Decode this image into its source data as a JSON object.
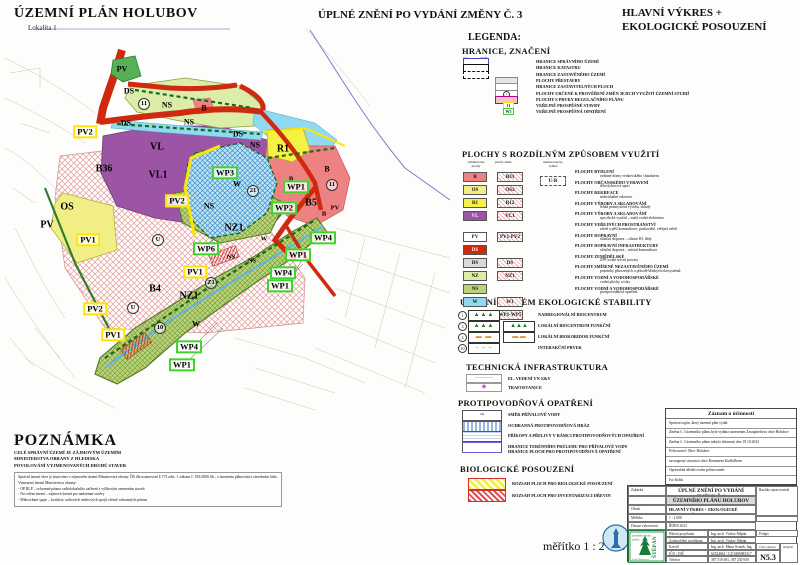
{
  "header": {
    "title_left": "ÚZEMNÍ PLÁN  HOLUBOV",
    "subtitle_left": "Lokalita 1",
    "title_center": "ÚPLNÉ ZNĚNÍ PO VYDÁNÍ ZMĚNY Č. 3",
    "title_right_line1": "HLAVNÍ VÝKRES +",
    "title_right_line2": "EKOLOGICKÉ POSOUZENÍ"
  },
  "colors": {
    "b_pink": "#ee8282",
    "os_yellow": "#f2ee86",
    "r1_yellow": "#f6f145",
    "vl_purple": "#9c55a5",
    "pv_green": "#56b054",
    "ds_red": "#cf2a10",
    "ds_gray": "#d9d9d9",
    "nz_green": "#dcedaa",
    "ns_olive": "#bdd277",
    "w_cyan": "#90d9f0",
    "yellow_box": "#ffe400",
    "green_box": "#3fd42a"
  },
  "map": {
    "labels": [
      {
        "t": "PV",
        "x": 117,
        "y": 41,
        "s": "m"
      },
      {
        "t": "DS",
        "x": 124,
        "y": 63,
        "s": "m"
      },
      {
        "t": "DS",
        "x": 121,
        "y": 95,
        "s": "m"
      },
      {
        "t": "DS",
        "x": 233,
        "y": 106,
        "s": "m"
      },
      {
        "t": "NS",
        "x": 162,
        "y": 77,
        "s": "m"
      },
      {
        "t": "NS",
        "x": 184,
        "y": 94,
        "s": "m"
      },
      {
        "t": "NS",
        "x": 250,
        "y": 117,
        "s": "m"
      },
      {
        "t": "B",
        "x": 199,
        "y": 80,
        "s": "m"
      },
      {
        "t": "B",
        "x": 322,
        "y": 141,
        "s": "m"
      },
      {
        "t": "B",
        "x": 286,
        "y": 151,
        "s": "s"
      },
      {
        "t": "B",
        "x": 319,
        "y": 186,
        "s": "s"
      },
      {
        "t": "B5",
        "x": 306,
        "y": 175,
        "s": "b"
      },
      {
        "t": "PV",
        "x": 330,
        "y": 180,
        "s": "s"
      },
      {
        "t": "R1",
        "x": 278,
        "y": 121,
        "s": "b"
      },
      {
        "t": "VL",
        "x": 152,
        "y": 119,
        "s": "b"
      },
      {
        "t": "VL1",
        "x": 153,
        "y": 147,
        "s": "b"
      },
      {
        "t": "B36",
        "x": 99,
        "y": 141,
        "s": "b"
      },
      {
        "t": "B4",
        "x": 150,
        "y": 261,
        "s": "b"
      },
      {
        "t": "OS",
        "x": 62,
        "y": 179,
        "s": "b"
      },
      {
        "t": "PV",
        "x": 42,
        "y": 197,
        "s": "b"
      },
      {
        "t": "W",
        "x": 232,
        "y": 156,
        "s": "m"
      },
      {
        "t": "W",
        "x": 259,
        "y": 211,
        "s": "s"
      },
      {
        "t": "W",
        "x": 191,
        "y": 296,
        "s": "m"
      },
      {
        "t": "NZ1",
        "x": 184,
        "y": 268,
        "s": "b"
      },
      {
        "t": "NZ1",
        "x": 229,
        "y": 200,
        "s": "b"
      },
      {
        "t": "NS",
        "x": 204,
        "y": 178,
        "s": "m"
      },
      {
        "t": "NS",
        "x": 226,
        "y": 229,
        "s": "s"
      },
      {
        "t": "NS",
        "x": 247,
        "y": 233,
        "s": "s"
      },
      {
        "t": "PV2",
        "x": 80,
        "y": 104,
        "s": "yb"
      },
      {
        "t": "PV2",
        "x": 172,
        "y": 173,
        "s": "yb"
      },
      {
        "t": "PV2",
        "x": 90,
        "y": 281,
        "s": "yb"
      },
      {
        "t": "PV1",
        "x": 83,
        "y": 212,
        "s": "yb"
      },
      {
        "t": "PV1",
        "x": 108,
        "y": 307,
        "s": "yb"
      },
      {
        "t": "PV1",
        "x": 190,
        "y": 244,
        "s": "yb"
      },
      {
        "t": "WP3",
        "x": 220,
        "y": 145,
        "s": "gb"
      },
      {
        "t": "WP1",
        "x": 291,
        "y": 159,
        "s": "gb"
      },
      {
        "t": "WP2",
        "x": 279,
        "y": 180,
        "s": "gb"
      },
      {
        "t": "WP4",
        "x": 318,
        "y": 210,
        "s": "gb"
      },
      {
        "t": "WP6",
        "x": 201,
        "y": 221,
        "s": "gb"
      },
      {
        "t": "WP1",
        "x": 293,
        "y": 227,
        "s": "gb"
      },
      {
        "t": "WP4",
        "x": 278,
        "y": 245,
        "s": "gb"
      },
      {
        "t": "WP1",
        "x": 275,
        "y": 258,
        "s": "gb"
      },
      {
        "t": "WP4",
        "x": 184,
        "y": 319,
        "s": "gb"
      },
      {
        "t": "WP1",
        "x": 177,
        "y": 337,
        "s": "gb"
      },
      {
        "t": "11",
        "x": 139,
        "y": 76,
        "s": "ci"
      },
      {
        "t": "21",
        "x": 248,
        "y": 163,
        "s": "ci"
      },
      {
        "t": "11",
        "x": 327,
        "y": 157,
        "s": "ci"
      },
      {
        "t": "U",
        "x": 153,
        "y": 212,
        "s": "ci"
      },
      {
        "t": "U",
        "x": 128,
        "y": 280,
        "s": "ci"
      },
      {
        "t": "Z1",
        "x": 206,
        "y": 255,
        "s": "ci"
      },
      {
        "t": "10",
        "x": 155,
        "y": 300,
        "s": "ci"
      }
    ]
  },
  "legend": {
    "title": "LEGENDA:",
    "hranice": {
      "title": "HRANICE, ZNAČENÍ",
      "col_stav": "stav",
      "col_navrh": "návrh",
      "items": [
        {
          "sw": "box-blue",
          "label": "HRANICE SPRÁVNÍHO ÚZEMÍ"
        },
        {
          "sw": "box-solid",
          "label": "HRANICE KATASTRU"
        },
        {
          "sw": "box-dash",
          "label": "HRANICE ZASTAVĚNÉHO ÚZEMÍ"
        },
        {
          "sw": "box-gray",
          "label": "PLOCHY PŘESTAVBY"
        },
        {
          "sw": "box-pinkline",
          "label": "HRANICE ZASTAVITELNÝCH PLOCH"
        },
        {
          "sw": "box-circle",
          "code": "1",
          "label": "PLOCHY URČENÉ K PROVĚŘENÍ ZMĚN JEJICH VYUŽITÍ ÚZEMNÍ STUDIÍ"
        },
        {
          "sw": "box-pinkfill",
          "label": "PLOCHY S PRVKY REGULAČNÍHO PLÁNU"
        },
        {
          "sw": "tag-yellow",
          "code": "11",
          "label": "VEŘEJNĚ PROSPĚŠNÉ STAVBY"
        },
        {
          "sw": "tag-green",
          "code": "W5",
          "label": "VEŘEJNĚ PROSPĚŠNÁ OPATŘENÍ"
        }
      ]
    },
    "plochy": {
      "title": "PLOCHY S ROZDÍLNÝM ZPŮSOBEM VYUŽITÍ",
      "col1": "stabilizované\nplochy",
      "col2": "plochy změn",
      "col3": "územní rezervy\nvýhled",
      "rezerva_code": "U-R",
      "stab": [
        {
          "code": "B",
          "fill": "#ee8282"
        },
        {
          "code": "OS",
          "fill": "#f2ee86"
        },
        {
          "code": "R1",
          "fill": "#f6f145"
        },
        {
          "code": "VL",
          "fill": "#9c55a5"
        },
        {
          "code": "PV",
          "fill": "#ffffff"
        },
        {
          "code": "DS",
          "fill": "#cf2a10"
        },
        {
          "code": "DS",
          "fill": "#d9d9d9"
        },
        {
          "code": "NZ",
          "fill": "#dcedaa"
        },
        {
          "code": "NS",
          "fill": "#bdd277"
        },
        {
          "code": "W",
          "fill": "#90d9f0"
        }
      ],
      "zmeny": [
        "B33",
        "OS2",
        "R12",
        "VL1",
        "PV1-PV2",
        "DS",
        "NZ1",
        "W1",
        "WP1-WP5"
      ],
      "items": [
        {
          "name": "PLOCHY BYDLENÍ",
          "sub": "rodinné domy venkovského charakteru"
        },
        {
          "name": "PLOCHY OBČANSKÉHO VYBAVENÍ",
          "sub": "tělovýchova a sport"
        },
        {
          "name": "PLOCHY REKREACE",
          "sub": "individuální rekreace"
        },
        {
          "name": "PLOCHY VÝROBY A SKLADOVÁNÍ",
          "sub": "lehká průmyslová výroba, sklady"
        },
        {
          "name": "PLOCHY VÝROBY A SKLADOVÁNÍ",
          "sub": "specifické využití – malá vodní elektrárna"
        },
        {
          "name": "PLOCHY VEŘEJNÝCH PROSTRANSTVÍ",
          "sub": "zeleň a pěší komunikace, parkoviště, veřejná zeleň"
        },
        {
          "name": "PLOCHY DOPRAVNÍ",
          "sub": "silniční doprava – silnice III. třídy"
        },
        {
          "name": "PLOCHY DOPRAVNÍ INFRASTRUKTURY",
          "sub": "silniční doprava – místní komunikace"
        },
        {
          "name": "PLOCHY ZEMĚDĚLSKÉ",
          "sub": "ZPF trvale travní porosty"
        },
        {
          "name": "PLOCHY SMÍŠENÉ NEZASTAVĚNÉHO ÚZEMÍ",
          "sub": "pozemky přirozených a přírodě blízkých ekosystémů"
        },
        {
          "name": "PLOCHY VODNÍ A VODOHOSPODÁŘSKÉ",
          "sub": "vodní plochy a toky"
        },
        {
          "name": "PLOCHY VODNÍ A VODOHOSPODÁŘSKÉ",
          "sub": "protipovodňová opatření"
        }
      ]
    },
    "uses": {
      "title": "ÚZEMNÍ SYSTÉM EKOLOGICKÉ STABILITY",
      "items": [
        {
          "num": "1",
          "sw": "trees",
          "label": "NADREGIONÁLNÍ BIOCENTRUM"
        },
        {
          "num": "3",
          "sw": "trees2",
          "label": "LOKÁLNÍ BIOCENTRUM FUNKČNÍ"
        },
        {
          "num": "4",
          "sw": "korid",
          "label": "LOKÁLNÍ BIOKORIDOR FUNKČNÍ"
        },
        {
          "num": "10",
          "sw": "inter",
          "label": "INTERAKČNÍ PRVEK"
        }
      ]
    },
    "tech": {
      "title": "TECHNICKÁ INFRASTRUKTURA",
      "items": [
        {
          "sw": "vn",
          "label": "EL. VEDENÍ VN 22kV"
        },
        {
          "sw": "trafo",
          "label": "TRAFOSTANICE"
        }
      ]
    },
    "flood": {
      "title": "PROTIPOVODŇOVÁ OPATŘENÍ",
      "items": [
        {
          "sw": "dir",
          "label": "SMĚR PŘÍVALOVÉ VODY"
        },
        {
          "sw": "hraz",
          "label": "OCHRANNÁ PROTIPOVODŇOVÁ HRÁZ"
        },
        {
          "sw": "preliv",
          "label": "PŘÍKOPY A PŘELIVY V RÁMCI PROTIPOVODŇOVÝCH OPATŘENÍ"
        },
        {
          "sw": "hranice",
          "label": "HRANICE TERÉNNÍHO PRŮLEHU PRO PŘÍVALOVÉ VODY",
          "label2": "HRANICE PLOCH PRO PROTIPOVODŇOVÁ OPATŘENÍ"
        }
      ]
    },
    "bio": {
      "title": "BIOLOGICKÉ POSOUZENÍ",
      "items": [
        {
          "sw": "byellow",
          "label": "ROZSAH PLOCH PRO BIOLOGICKÉ POSOUZENÍ"
        },
        {
          "sw": "bred",
          "label": "ROZSAH PLOCH PRO INVENTARIZACI DŘEVIN"
        }
      ]
    }
  },
  "poznamka": {
    "title": "POZNÁMKA",
    "bold_lines": [
      "CELÉ SPRÁVNÍ ÚZEMÍ JE ZÁJMOVÝM ÚZEMÍM",
      "MINISTERSTVA OBRANY Z HLEDISKA",
      "POVOLOVÁNÍ VYJMENOVANÝCH DRUHŮ STAVEB"
    ],
    "para1": "Správní území obce je situováno v zájmovém území Ministerstva obrany ČR dle ustanovení § 175 odst. 1 zákona č. 183/2006 Sb., o územním plánování a stavebním řádu.",
    "para2": "Vymezená území Ministerstva obrany:",
    "bullets": [
      "OP RLP – ochranné pásmo radiolokačního zařízení s výškovým omezením staveb",
      "Na celém území – zájmové území pro nadzemní stavby",
      "Mikrovlnné spoje – koridory radiových směrových spojů včetně ochranných pásem"
    ]
  },
  "zaznam": {
    "title": "Záznam o účinnosti",
    "lines": [
      "Správní orgán, který územní plán vydal:",
      "Změna č. 3 územního plánu byla vydána usnesením Zastupitelstva obce Holubov",
      "Změna č. 3 územního plánu nabyla účinnosti dne 19.10.2023",
      "Pořizovatel:  Obec Holubov",
      "zastoupený starostou obce Romanem Kudláčkem",
      "Oprávněná úřední osoba pořizovatele:",
      "Ivo Kolín"
    ]
  },
  "titleblock": {
    "zakazka_label": "Zakázka",
    "zakazka_value1": "ÚPLNÉ ZNĚNÍ PO VYDÁNÍ ZMĚNY Č. 3",
    "zakazka_value2": "ÚZEMNÍHO PLÁNU HOLUBOV",
    "razitko_label": "Razítko zpracovatele",
    "obsah_label": "Obsah",
    "obsah_value": "HLAVNÍ VÝKRES + EKOLOGICKÉ POSOUZENÍ",
    "meritko_label": "Měřítko",
    "meritko_value": "1 : 2 000",
    "datum_label": "Datum vyhotovení",
    "datum_value": "ŘÍJEN 2023",
    "rows": [
      {
        "label": "Hlavní projektant",
        "value": "Ing. arch. Václav Štěpán",
        "extra": "Podpis"
      },
      {
        "label": "Zodpovědný projektant",
        "value": "Ing. arch. Václav Štěpán",
        "extra": ""
      },
      {
        "label": "Kreslil",
        "value": "Ing. arch. Marta Svatek, Ing. Drahomil Stanko",
        "extra": ""
      },
      {
        "label": "IČO / DIČ",
        "value": "62524661 / CZ 6309081317",
        "extra": ""
      },
      {
        "label": "Telefon",
        "value": "387 318 491, 387 230 930",
        "extra": ""
      }
    ],
    "cislo_label": "Číslo výkresu",
    "cislo_value": "N5.3",
    "original_label": "Originál",
    "logo": {
      "l1": "architektonický",
      "l2": "ateliér",
      "name": "ŠTĚPÁN",
      "addr": "České Budějovice"
    }
  },
  "scale_text": "měřítko 1 : 2 000"
}
